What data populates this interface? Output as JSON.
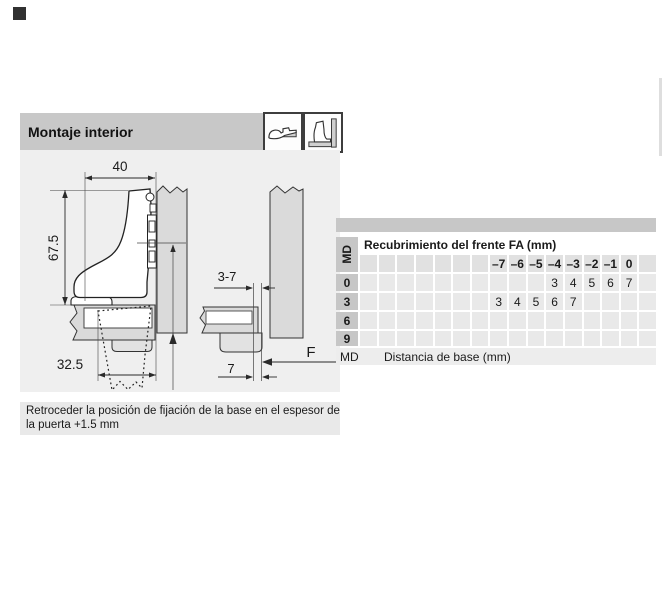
{
  "header": {
    "title": "Montaje interior",
    "icons": [
      "overlay-hinge-icon",
      "inset-hinge-icon"
    ]
  },
  "diagram": {
    "dim_top_width": "40",
    "dim_side_height": "67.5",
    "dim_base_setback": "32.5",
    "dim_door_gap": "3-7",
    "dim_edge_distance": "7",
    "dim_overlay_label": "F",
    "caption_line1": "Retroceder la posición de fijación de la base en el espesor de",
    "caption_line2": "la puerta +1.5 mm"
  },
  "table": {
    "title": "Recubrimiento del frente FA (mm)",
    "row_header_label": "MD",
    "columns": [
      "",
      "",
      "",
      "",
      "",
      "",
      "",
      "–7",
      "–6",
      "–5",
      "–4",
      "–3",
      "–2",
      "–1",
      "0",
      ""
    ],
    "rows": [
      {
        "label": "0",
        "values": [
          "",
          "",
          "",
          "",
          "",
          "",
          "",
          "",
          "",
          "",
          "3",
          "4",
          "5",
          "6",
          "7",
          ""
        ]
      },
      {
        "label": "3",
        "values": [
          "",
          "",
          "",
          "",
          "",
          "",
          "",
          "3",
          "4",
          "5",
          "6",
          "7",
          "",
          "",
          "",
          ""
        ]
      },
      {
        "label": "6",
        "values": [
          "",
          "",
          "",
          "",
          "",
          "",
          "",
          "",
          "",
          "",
          "",
          "",
          "",
          "",
          "",
          ""
        ]
      },
      {
        "label": "9",
        "values": [
          "",
          "",
          "",
          "",
          "",
          "",
          "",
          "",
          "",
          "",
          "",
          "",
          "",
          "",
          "",
          ""
        ]
      }
    ],
    "footer": {
      "abbr": "MD",
      "text": "Distancia de base (mm)"
    }
  },
  "colors": {
    "header_band": "#c8c8c8",
    "drawing_bg": "#efefef",
    "caption_band": "#e9e9e9",
    "board_fill": "#dadada",
    "label_cell": "#c6c6c6",
    "data_cell": "#e9e9e9"
  }
}
